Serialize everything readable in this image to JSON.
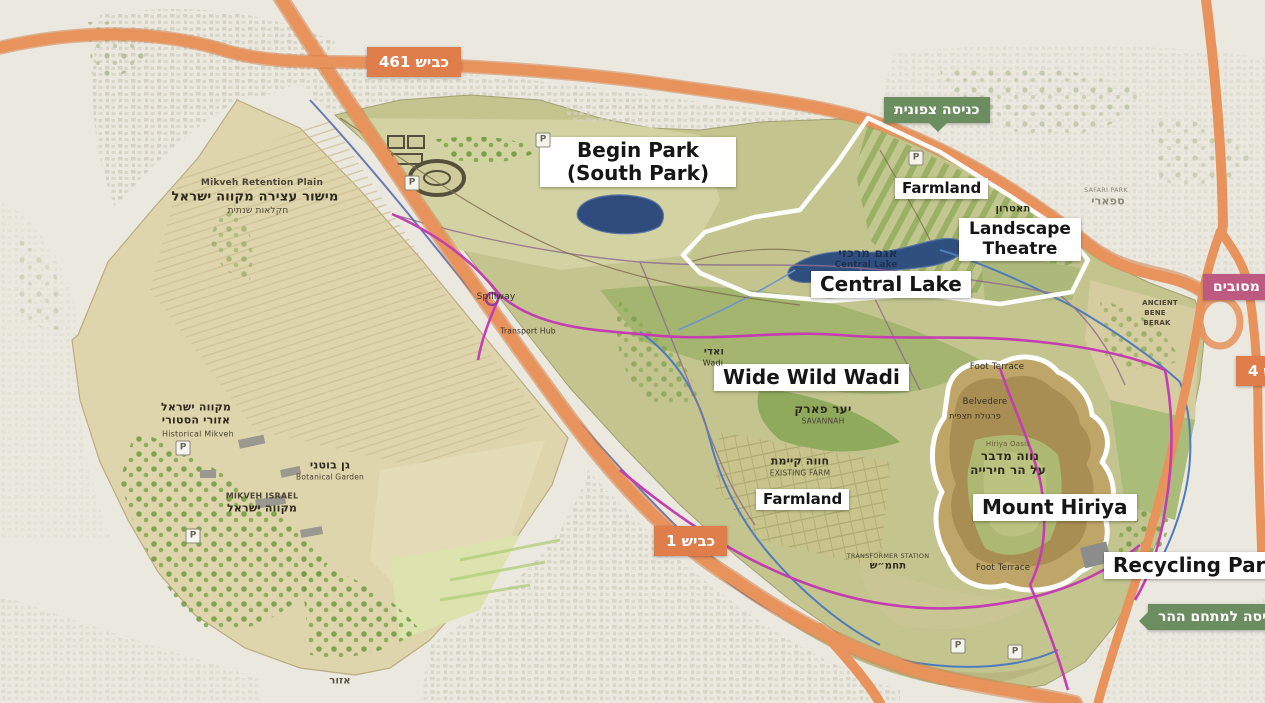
{
  "map_name": "park-master-plan-map",
  "colors": {
    "highway_orange": "#e8925c",
    "highway_edge": "#d07b43",
    "badge_orange": "#df7d4b",
    "badge_green": "#6c8d60",
    "badge_pink": "#be5982",
    "lake_blue": "#2f4f7e",
    "path_magenta": "#c43db2",
    "channel_blue": "#4e7cbc",
    "park_green": "#c3c48e",
    "farm_tan": "#dfd5ad",
    "boundary_white": "#ffffff"
  },
  "labels": {
    "begin_park": {
      "line1": "Begin Park",
      "line2": "(South Park)"
    },
    "farmland_north": "Farmland",
    "landscape_theatre": {
      "line1": "Landscape",
      "line2": "Theatre"
    },
    "central_lake": "Central Lake",
    "wide_wild_wadi": "Wide Wild Wadi",
    "farmland_south": "Farmland",
    "mount_hiriya": "Mount Hiriya",
    "recycling_park": "Recycling Park"
  },
  "badges": {
    "road_461": "כביש 461",
    "road_1": "כביש 1",
    "road_4": "כביש 4",
    "mesubim_interchange": "מחלף מסובים",
    "north_entrance": "כניסה צפונית",
    "mount_entrance": "כניסה למתחם ההר"
  },
  "parking": {
    "glyph": "P",
    "positions": [
      {
        "x": 412,
        "y": 183
      },
      {
        "x": 543,
        "y": 140
      },
      {
        "x": 916,
        "y": 158
      },
      {
        "x": 183,
        "y": 448
      },
      {
        "x": 193,
        "y": 536
      },
      {
        "x": 958,
        "y": 646
      },
      {
        "x": 1015,
        "y": 652
      }
    ]
  },
  "annotations": [
    {
      "text": "Mikveh Retention Plain",
      "x": 262,
      "y": 183,
      "size": 9,
      "color": "#4a4434",
      "bold": true
    },
    {
      "text": "מישור עצירה מקווה ישראל",
      "x": 255,
      "y": 197,
      "size": 13,
      "color": "#2e2a1c",
      "bold": true
    },
    {
      "text": "חקלאות שנתית",
      "x": 258,
      "y": 211,
      "size": 9,
      "color": "#4a4434"
    },
    {
      "text": "מקווה ישראל",
      "x": 196,
      "y": 407,
      "size": 11,
      "color": "#2e2a1c",
      "bold": true
    },
    {
      "text": "אזורי הסטורי",
      "x": 196,
      "y": 420,
      "size": 11,
      "color": "#2e2a1c",
      "bold": true
    },
    {
      "text": "Historical Mikveh",
      "x": 198,
      "y": 434,
      "size": 8,
      "color": "#4a4434"
    },
    {
      "text": "גן בוטני",
      "x": 330,
      "y": 465,
      "size": 11,
      "color": "#2e2a1c",
      "bold": true
    },
    {
      "text": "Botanical Garden",
      "x": 330,
      "y": 477,
      "size": 7.5,
      "color": "#4a4434"
    },
    {
      "text": "MIKVEH ISRAEL",
      "x": 262,
      "y": 496,
      "size": 8,
      "color": "#4a4434",
      "bold": true
    },
    {
      "text": "מקווה ישראל",
      "x": 262,
      "y": 508,
      "size": 11,
      "color": "#2e2a1c",
      "bold": true
    },
    {
      "text": "Spillway",
      "x": 496,
      "y": 297,
      "size": 9,
      "color": "#33302a"
    },
    {
      "text": "Transport Hub",
      "x": 528,
      "y": 331,
      "size": 7.5,
      "color": "#33302a"
    },
    {
      "text": "ואדי",
      "x": 714,
      "y": 352,
      "size": 10,
      "color": "#33302a",
      "bold": true
    },
    {
      "text": "Wadi",
      "x": 713,
      "y": 363,
      "size": 8,
      "color": "#33302a"
    },
    {
      "text": "יער פארק",
      "x": 823,
      "y": 409,
      "size": 12,
      "color": "#2e2a1c",
      "bold": true
    },
    {
      "text": "SAVANNAH",
      "x": 823,
      "y": 421,
      "size": 7.5,
      "color": "#4a4434"
    },
    {
      "text": "חווה קיימת",
      "x": 800,
      "y": 461,
      "size": 11,
      "color": "#2e2a1c",
      "bold": true
    },
    {
      "text": "EXISTING FARM",
      "x": 800,
      "y": 473,
      "size": 7.5,
      "color": "#4a4434"
    },
    {
      "text": "TRANSFORMER STATION",
      "x": 888,
      "y": 556,
      "size": 6.5,
      "color": "#4a4434"
    },
    {
      "text": "תחמ״ש",
      "x": 888,
      "y": 566,
      "size": 10,
      "color": "#2e2a1c",
      "bold": true
    },
    {
      "text": "Foot Terrace",
      "x": 997,
      "y": 367,
      "size": 8.5,
      "color": "#33302a"
    },
    {
      "text": "Belvedere",
      "x": 985,
      "y": 402,
      "size": 8.5,
      "color": "#33302a"
    },
    {
      "text": "פרגולת תצפית",
      "x": 975,
      "y": 416,
      "size": 8,
      "color": "#2e2a1c"
    },
    {
      "text": "Hiriya Oasis",
      "x": 1008,
      "y": 444,
      "size": 7,
      "color": "#6b5b35"
    },
    {
      "text": "נווה מדבר",
      "x": 1010,
      "y": 456,
      "size": 12,
      "color": "#2e2a1c",
      "bold": true
    },
    {
      "text": "על הר חירייה",
      "x": 1008,
      "y": 470,
      "size": 12,
      "color": "#2e2a1c",
      "bold": true
    },
    {
      "text": "Foot Terrace",
      "x": 1003,
      "y": 568,
      "size": 8.5,
      "color": "#33302a"
    },
    {
      "text": "ANCIENT",
      "x": 1160,
      "y": 303,
      "size": 7,
      "color": "#4a4434",
      "bold": true
    },
    {
      "text": "BENE",
      "x": 1155,
      "y": 313,
      "size": 7,
      "color": "#4a4434",
      "bold": true
    },
    {
      "text": "BERAK",
      "x": 1157,
      "y": 323,
      "size": 7,
      "color": "#4a4434",
      "bold": true
    },
    {
      "text": "אגם מרכזי",
      "x": 868,
      "y": 253,
      "size": 12,
      "color": "#1e3050",
      "bold": true
    },
    {
      "text": "Central Lake",
      "x": 866,
      "y": 265,
      "size": 8.5,
      "color": "#1e3050",
      "bold": true
    },
    {
      "text": "תאטרון",
      "x": 1013,
      "y": 209,
      "size": 10,
      "color": "#2e2a1c",
      "bold": true
    },
    {
      "text": "SAFARI PARK",
      "x": 1106,
      "y": 190,
      "size": 6.5,
      "color": "#8d887b"
    },
    {
      "text": "ספארי",
      "x": 1108,
      "y": 201,
      "size": 11,
      "color": "#8d887b",
      "bold": true
    },
    {
      "text": "אזור",
      "x": 340,
      "y": 681,
      "size": 10,
      "color": "#5a523f",
      "bold": true
    }
  ]
}
